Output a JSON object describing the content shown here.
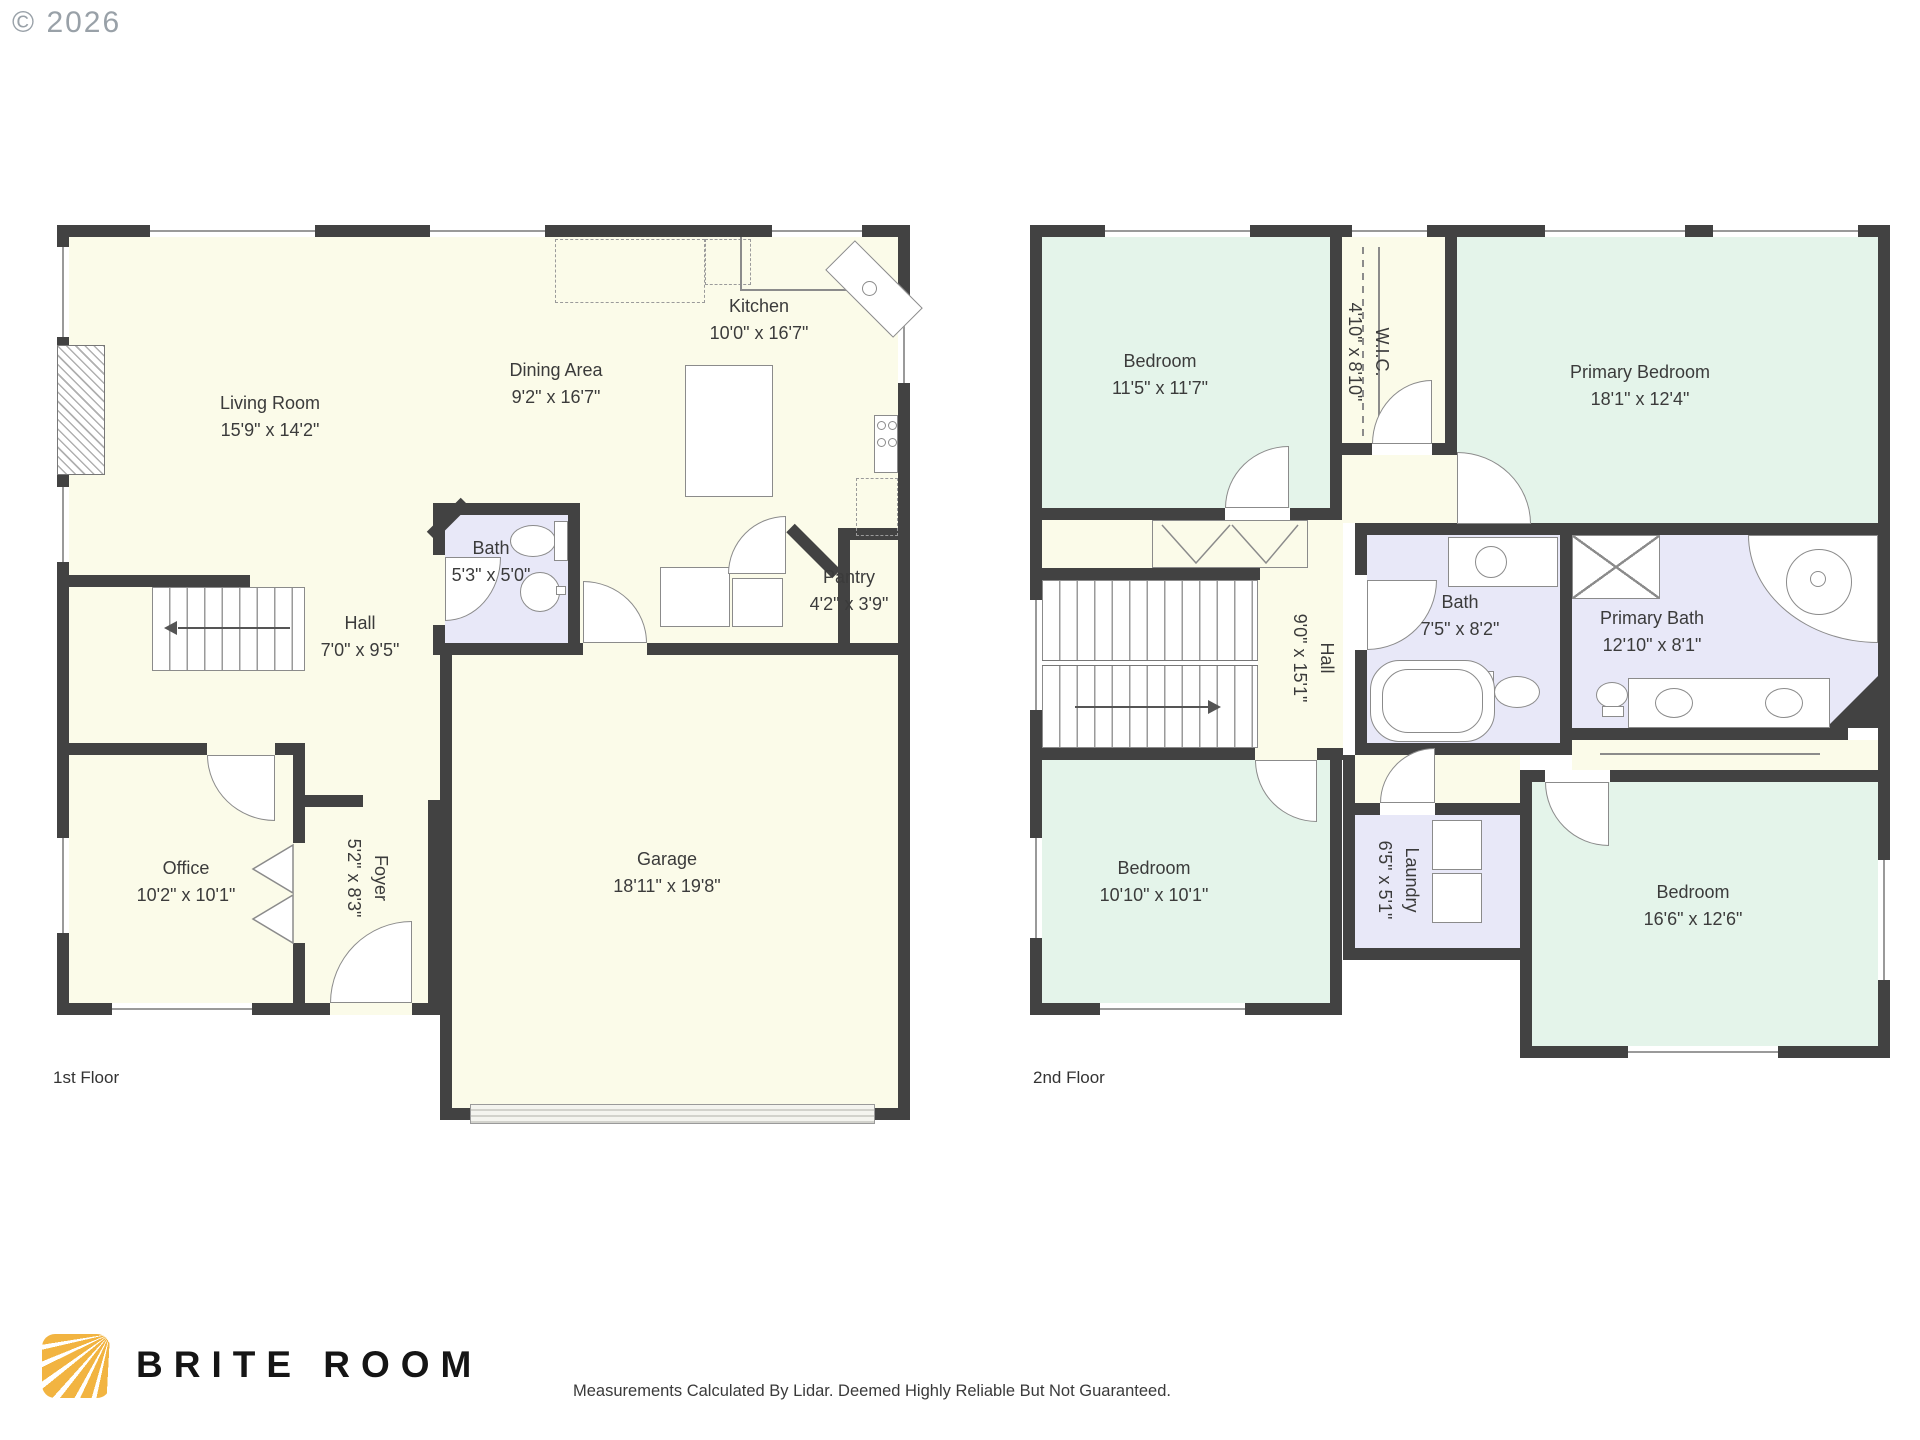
{
  "meta": {
    "copyright": "© 2026"
  },
  "floors": [
    {
      "label": "1st Floor",
      "rooms": [
        {
          "name": "Living Room",
          "dims": "15'9\" x 14'2\""
        },
        {
          "name": "Dining Area",
          "dims": "9'2\" x 16'7\""
        },
        {
          "name": "Kitchen",
          "dims": "10'0\" x 16'7\""
        },
        {
          "name": "Bath",
          "dims": "5'3\" x 5'0\""
        },
        {
          "name": "Pantry",
          "dims": "4'2\" x 3'9\""
        },
        {
          "name": "Hall",
          "dims": "7'0\" x 9'5\""
        },
        {
          "name": "Office",
          "dims": "10'2\" x 10'1\""
        },
        {
          "name": "Foyer",
          "dims": "5'2\" x 8'3\""
        },
        {
          "name": "Garage",
          "dims": "18'11\" x 19'8\""
        }
      ]
    },
    {
      "label": "2nd Floor",
      "rooms": [
        {
          "name": "Bedroom",
          "dims": "11'5\" x 11'7\""
        },
        {
          "name": "W.I.C.",
          "dims": "4'10\" x 8'10\""
        },
        {
          "name": "Primary Bedroom",
          "dims": "18'1\" x 12'4\""
        },
        {
          "name": "Bath",
          "dims": "7'5\" x 8'2\""
        },
        {
          "name": "Hall",
          "dims": "9'0\" x 15'1\""
        },
        {
          "name": "Primary Bath",
          "dims": "12'10\" x 8'1\""
        },
        {
          "name": "Bedroom",
          "dims": "10'10\" x 10'1\""
        },
        {
          "name": "Laundry",
          "dims": "6'5\" x 5'1\""
        },
        {
          "name": "Bedroom",
          "dims": "16'6\" x 12'6\""
        }
      ]
    }
  ],
  "footer": {
    "brand": "BRITE ROOM",
    "disclaimer": "Measurements Calculated By Lidar. Deemed Highly Reliable But Not Guaranteed."
  },
  "colors": {
    "wall": "#424242",
    "floor_cream": "#FBFBE9",
    "floor_mint": "#E4F4EA",
    "floor_lavender": "#E8E8F8",
    "logo_yellow": "#F2B441"
  }
}
